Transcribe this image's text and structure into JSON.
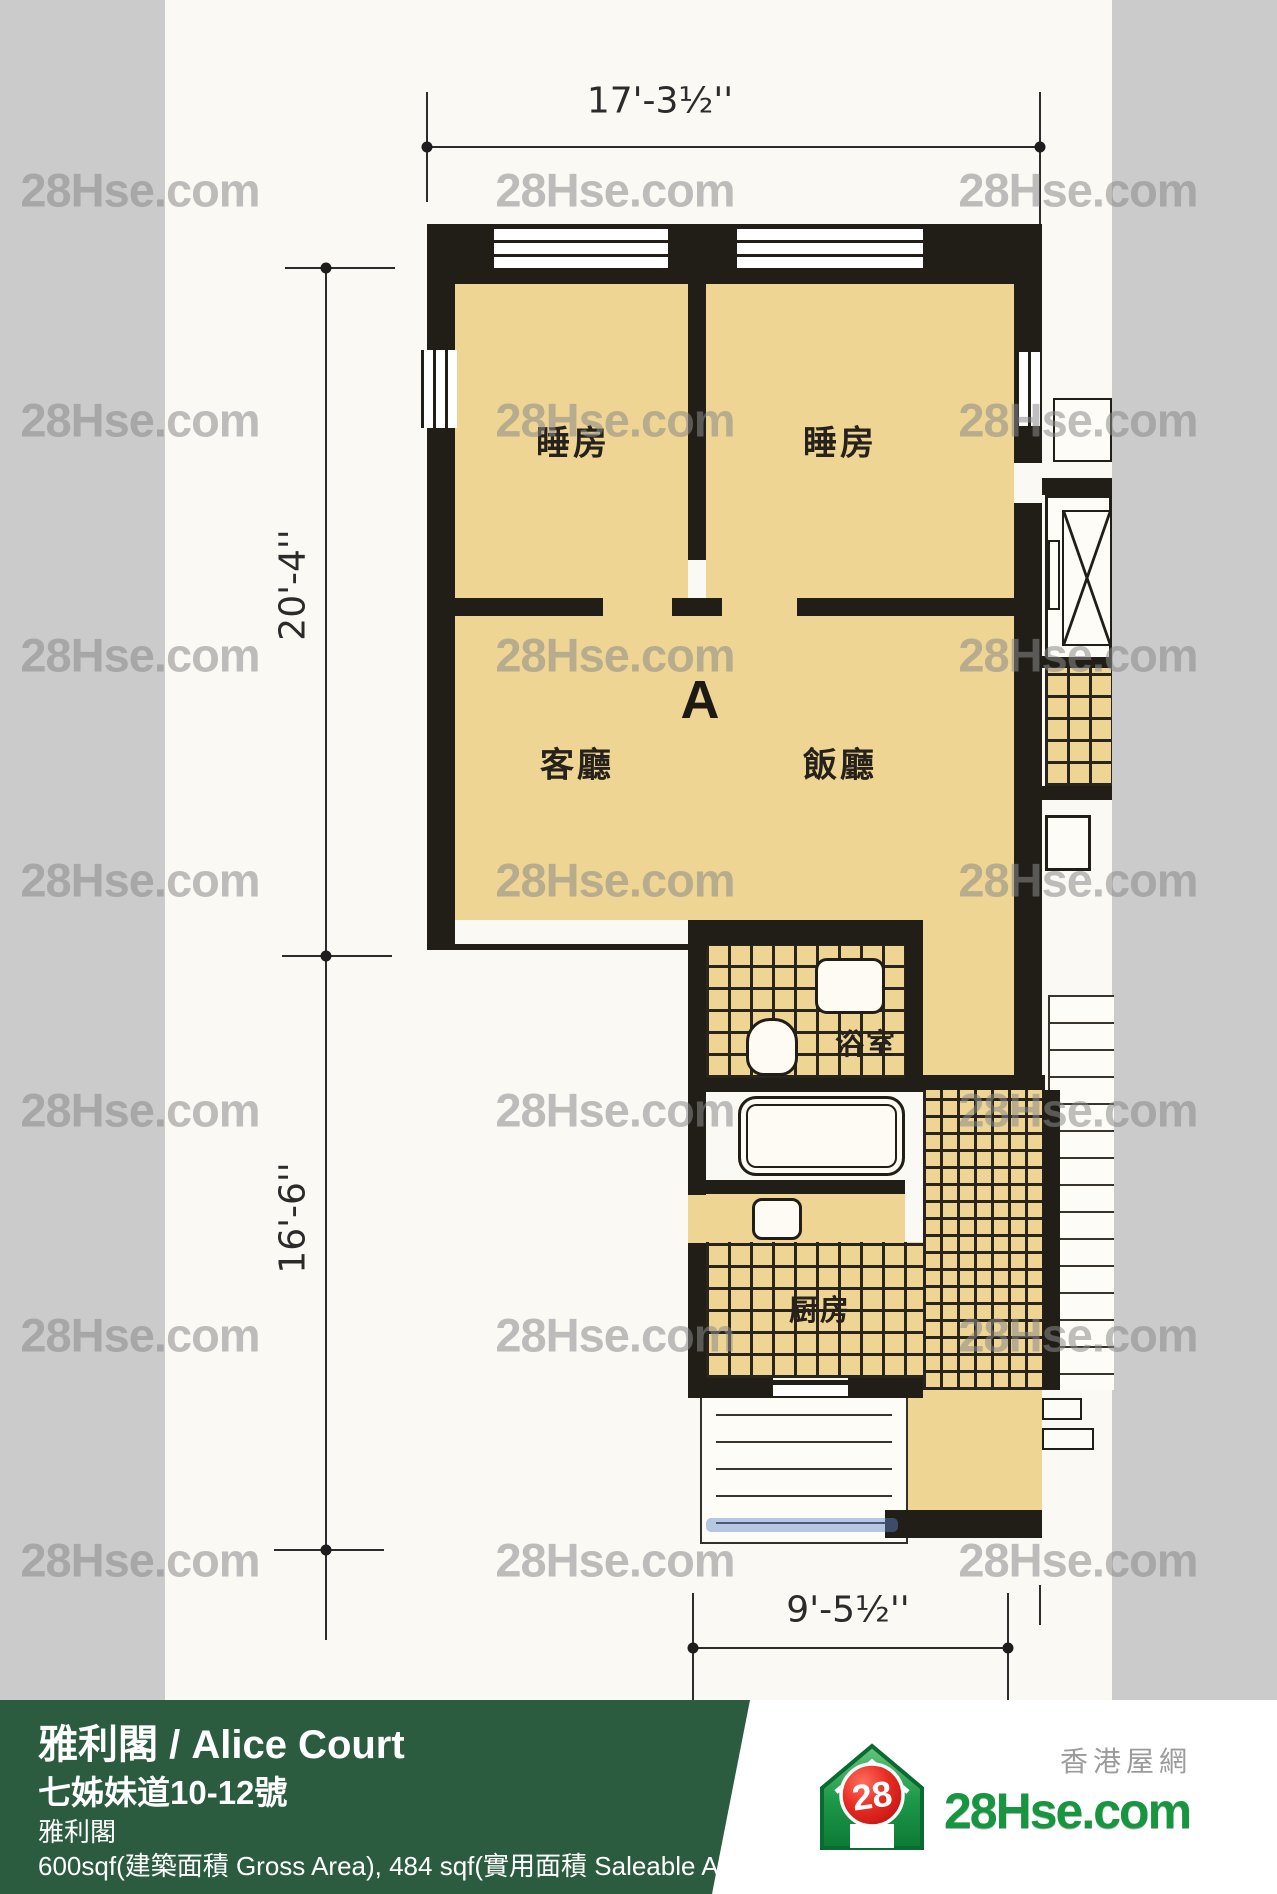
{
  "watermark": {
    "text": "28Hse.com"
  },
  "plan": {
    "unit_label": "A",
    "rooms": {
      "bedroom1": "睡房",
      "bedroom2": "睡房",
      "living": "客廳",
      "dining": "飯廳",
      "bathroom": "浴室",
      "kitchen": "厨房"
    },
    "dimensions": {
      "top": "17'-3½''",
      "left_upper": "20'-4''",
      "left_lower": "16'-6''",
      "bottom": "9'-5½''"
    },
    "colors": {
      "room_fill": "#eed593",
      "wall": "#211e18",
      "paper": "#fbf9f3",
      "side_strip": "#cbcbcb"
    }
  },
  "footer": {
    "title": "雅利閣 / Alice Court",
    "address": "七姊妹道10-12號",
    "estate": "雅利閣",
    "area_info": "600sqf(建築面積 Gross Area), 484 sqf(實用面積 Saleable Area)",
    "banner_green": "#2b5c40"
  },
  "logo": {
    "badge_number": "28",
    "site_name": "28Hse.com",
    "chinese_name": "香港屋網",
    "brand_green": "#17953f",
    "badge_red": "#df2420"
  }
}
